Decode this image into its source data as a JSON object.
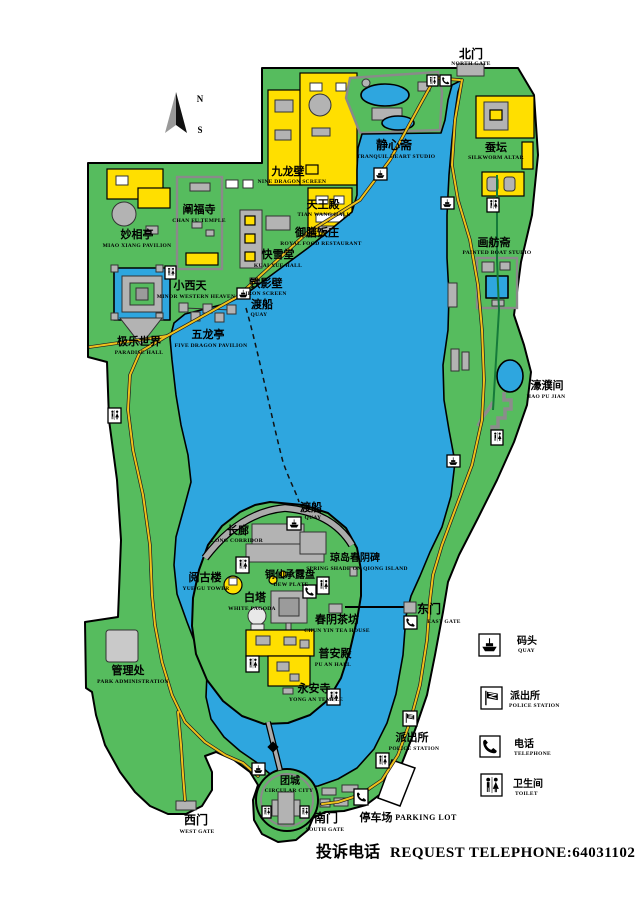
{
  "compass": {
    "north": "N",
    "south": "S"
  },
  "colors": {
    "water": "#2EA6DF",
    "land": "#56BC5E",
    "building_yellow": "#FFDF00",
    "building_gray": "#B3B3B3",
    "road": "#EFC11C"
  },
  "places": {
    "north_gate": {
      "zh": "北门",
      "en": "NORTH GATE"
    },
    "tranquil_heart": {
      "zh": "静心斋",
      "en": "TRANQUIL HEART STUDIO"
    },
    "silkworm_altar": {
      "zh": "蚕坛",
      "en": "SILKWORM ALTAR"
    },
    "nine_dragon_screen": {
      "zh": "九龙壁",
      "en": "NINE DRAGON SCREEN"
    },
    "tian_wang_hall": {
      "zh": "天王殿",
      "en": "TIAN WANG HALL"
    },
    "chan_fu_temple": {
      "zh": "阐福寺",
      "en": "CHAN FU TEMPLE"
    },
    "royal_food": {
      "zh": "御膳饭庄",
      "en": "ROYAL FOOD RESTAURANT"
    },
    "miao_xiang": {
      "zh": "妙相亭",
      "en": "MIAO XIANG PAVILION"
    },
    "kuai_xue_hall": {
      "zh": "快雪堂",
      "en": "KUAI XUE HALL"
    },
    "painted_boat": {
      "zh": "画舫斋",
      "en": "PAINTED BOAT STUDIO"
    },
    "minor_western_heaven": {
      "zh": "小西天",
      "en": "MINOR WESTERN HEAVEN"
    },
    "iron_screen": {
      "zh": "铁影壁",
      "en": "IRON SCREEN"
    },
    "quay_north": {
      "zh": "渡船",
      "en": "QUAY"
    },
    "five_dragon_pavilion": {
      "zh": "五龙亭",
      "en": "FIVE DRAGON PAVILION"
    },
    "paradise_hall": {
      "zh": "极乐世界",
      "en": "PARADISE HALL"
    },
    "hao_pu_jian": {
      "zh": "濠濮间",
      "en": "HAO PU JIAN"
    },
    "park_admin": {
      "zh": "管理处",
      "en": "PARK ADMINISTRATION"
    },
    "long_corridor": {
      "zh": "长廊",
      "en": "LONG CORRIDOR"
    },
    "quay_island": {
      "zh": "渡船",
      "en": "QUAY"
    },
    "spring_shade": {
      "zh": "琼岛春阴碑",
      "en": "SPRING SHADE ON QIONG ISLAND"
    },
    "yue_gu_tower": {
      "zh": "阅古楼",
      "en": "YUE GU TOWER"
    },
    "dew_plate": {
      "zh": "铜仙承露盘",
      "en": "DEW PLATE"
    },
    "white_pagoda": {
      "zh": "白塔",
      "en": "WHITE PAGODA"
    },
    "east_gate": {
      "zh": "东门",
      "en": "EAST GATE"
    },
    "tea_house": {
      "zh": "春阴茶坊",
      "en": "CHUN YIN TEA HOUSE"
    },
    "pu_an_hall": {
      "zh": "普安殿",
      "en": "PU AN HALL"
    },
    "yong_an_temple": {
      "zh": "永安寺",
      "en": "YONG AN TEMPLE"
    },
    "police_station_map": {
      "zh": "派出所",
      "en": "POLICE STATION"
    },
    "circular_city": {
      "zh": "团城",
      "en": "CIRCULAR CITY"
    },
    "west_gate": {
      "zh": "西门",
      "en": "WEST GATE"
    },
    "south_gate": {
      "zh": "南门",
      "en": "SOUTH GATE"
    },
    "parking": {
      "zh": "停车场",
      "en": "PARKING LOT"
    }
  },
  "legend": {
    "items": [
      {
        "zh": "码头",
        "en": "QUAY",
        "icon": "quay-icon"
      },
      {
        "zh": "派出所",
        "en": "POLICE STATION",
        "icon": "police-icon"
      },
      {
        "zh": "电话",
        "en": "TELEPHONE",
        "icon": "telephone-icon"
      },
      {
        "zh": "卫生间",
        "en": "TOILET",
        "icon": "toilet-icon"
      }
    ]
  },
  "footer": {
    "zh": "投诉电话",
    "en": "REQUEST TELEPHONE:64031102"
  }
}
